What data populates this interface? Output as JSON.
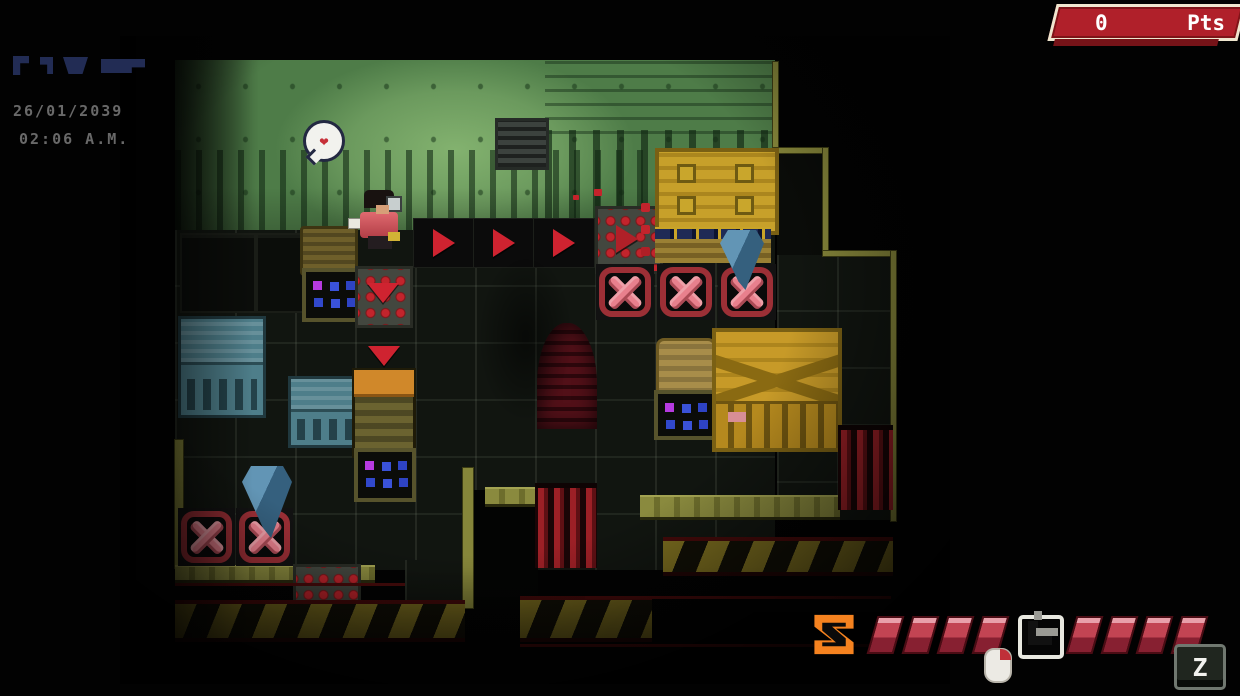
{
  "hud": {
    "score": {
      "value": "0",
      "unit": "Pts"
    },
    "clock": {
      "date": "26/01/2039",
      "time": "02:06 A.M."
    },
    "abilities": {
      "primary": {
        "icon": "z-skill-icon",
        "charges": 4,
        "max": 4,
        "input_hint": "mouse-click"
      },
      "secondary": {
        "icon": "lever-skill-icon",
        "charges": 4,
        "max": 4,
        "key_label": "Z"
      }
    },
    "colors": {
      "score_red": "#b0202a",
      "pip_red": "#c24453",
      "accent_orange": "#f5821f",
      "clock_gray": "#696969",
      "glitch_navy": "#222c54"
    }
  },
  "scene": {
    "bubble": {
      "icon": "heart-icon",
      "glyph": "❤"
    }
  }
}
